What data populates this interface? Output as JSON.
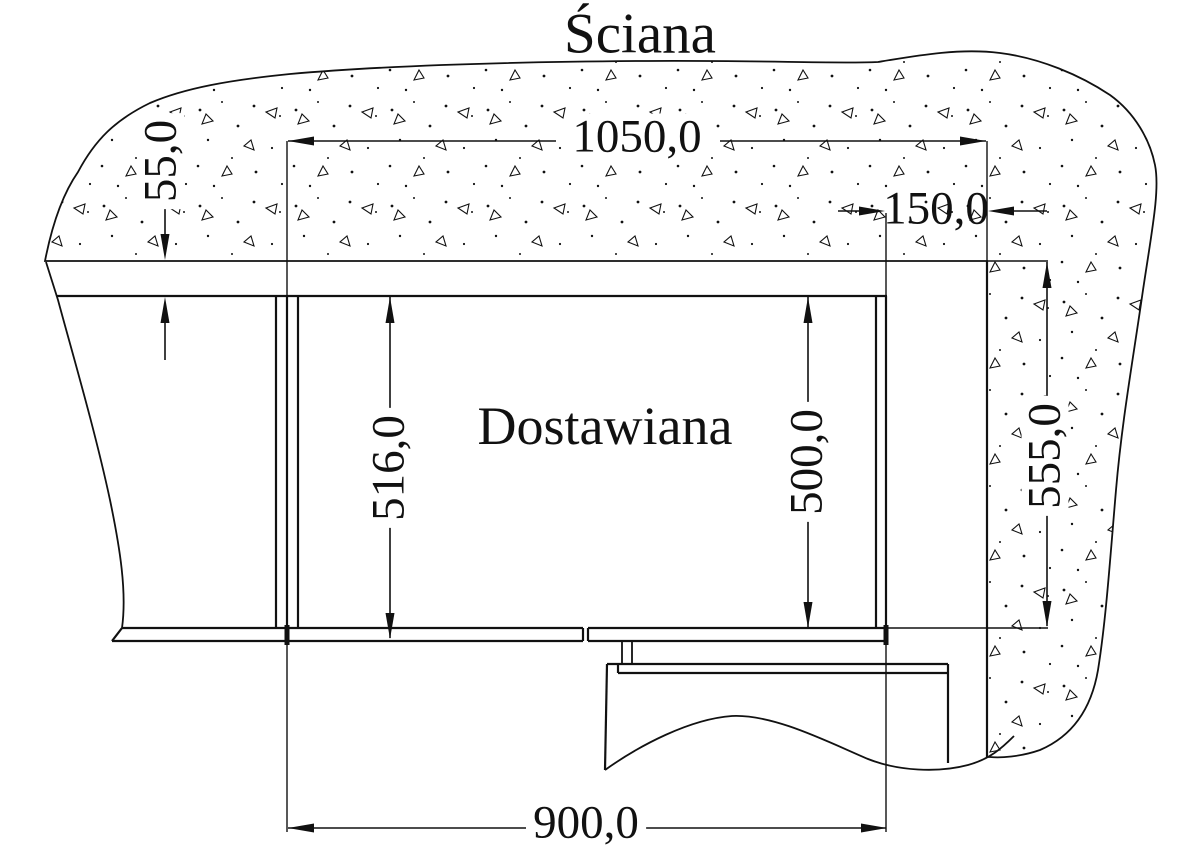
{
  "drawing": {
    "title": "Ściana",
    "unit_label": "Dostawiana",
    "dimensions": {
      "top_width": "1050,0",
      "column_offset": "150,0",
      "wall_band": "55,0",
      "depth_outer": "516,0",
      "depth_inner": "500,0",
      "column_depth": "555,0",
      "unit_width": "900,0"
    },
    "colors": {
      "line": "#111111",
      "background": "#ffffff"
    }
  }
}
